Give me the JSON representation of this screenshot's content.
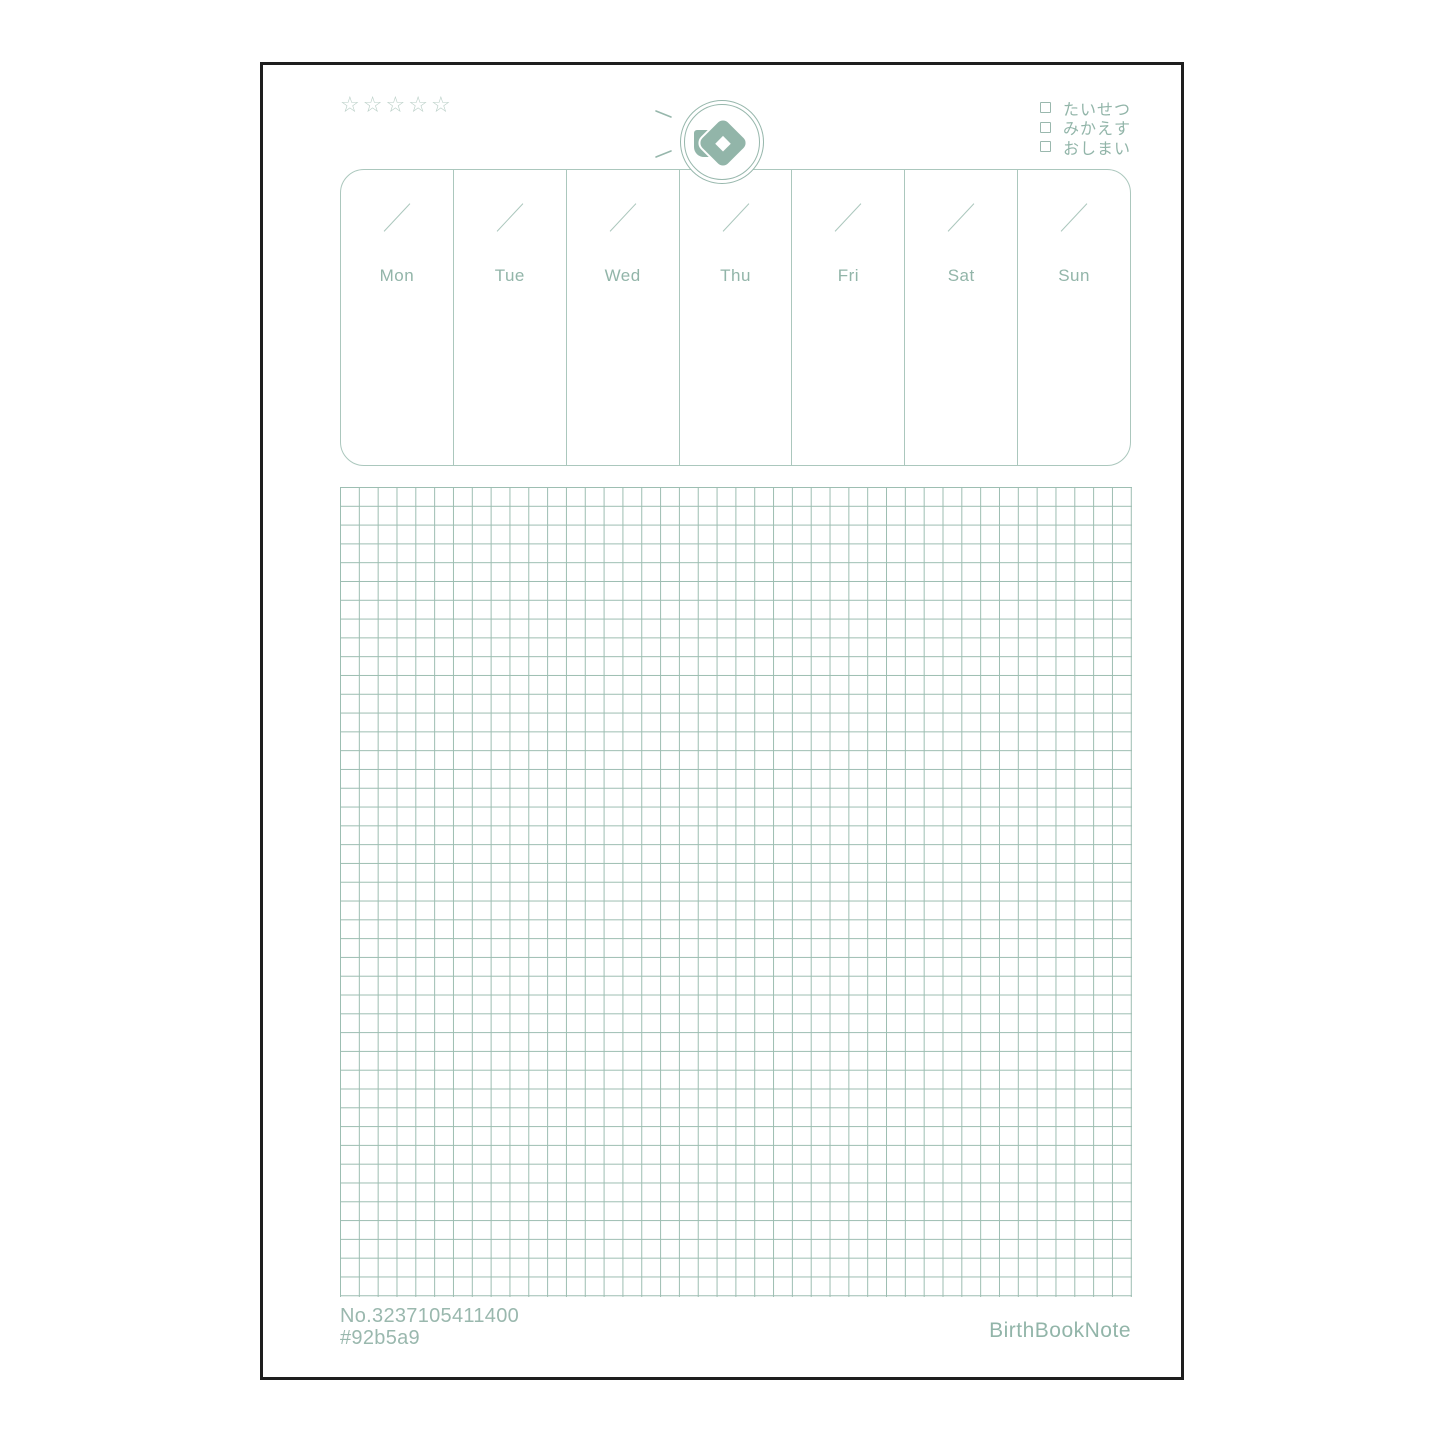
{
  "rating": {
    "star_glyph": "☆",
    "star_count": 5
  },
  "checklist": {
    "items": [
      {
        "label": "たいせつ",
        "checked": false
      },
      {
        "label": "みかえす",
        "checked": false
      },
      {
        "label": "おしまい",
        "checked": false
      }
    ]
  },
  "logo": {
    "shape": "diamond-gem-in-double-circle"
  },
  "week": {
    "days": [
      {
        "label": "Mon"
      },
      {
        "label": "Tue"
      },
      {
        "label": "Wed"
      },
      {
        "label": "Thu"
      },
      {
        "label": "Fri"
      },
      {
        "label": "Sat"
      },
      {
        "label": "Sun"
      }
    ]
  },
  "grid": {
    "cols": 42,
    "rows": 43
  },
  "footer": {
    "product_no": "No.3237105411400",
    "color_code": "#92b5a9",
    "brand": "BirthBookNote"
  },
  "colors": {
    "primary": "#92b5a9",
    "week-line": "#abc7bd",
    "grid-line": "#9cbdb1",
    "star": "#bbd0c8",
    "ring": "#97b7ac",
    "muted": "#9ab8ae",
    "sheet-border": "#1e1e1e"
  }
}
